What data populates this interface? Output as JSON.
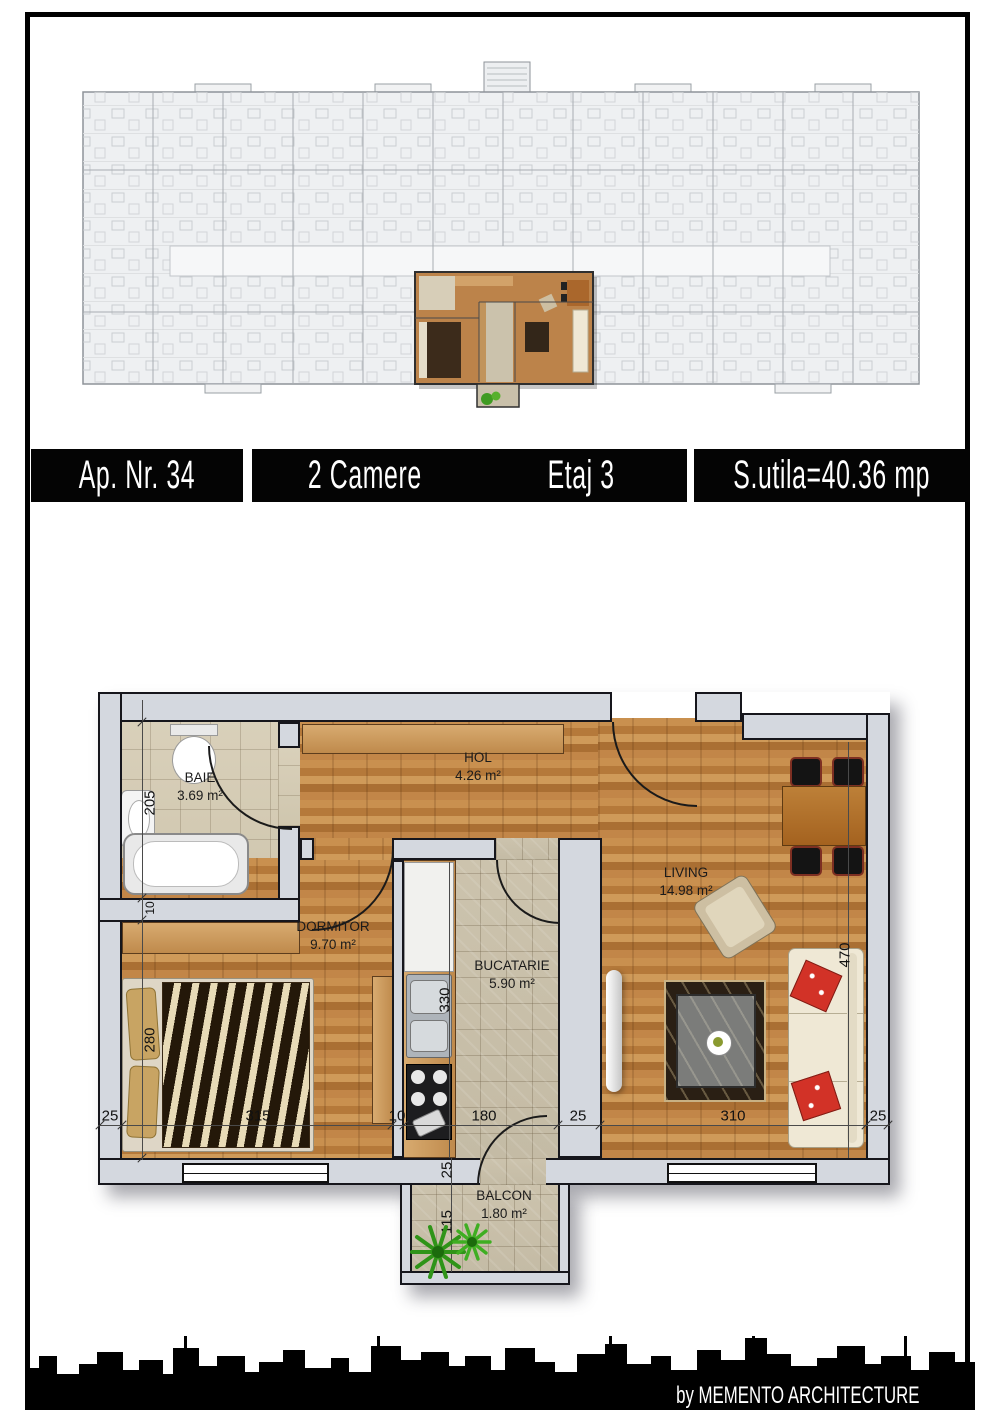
{
  "banner": {
    "items": [
      {
        "label": "Ap. Nr. 34"
      },
      {
        "label": "2 Camere"
      },
      {
        "label": "Etaj 3"
      },
      {
        "label": "S.utila=40.36 mp"
      }
    ]
  },
  "rooms": {
    "baie": {
      "name": "BAIE",
      "area": "3.69 m²"
    },
    "hol": {
      "name": "HOL",
      "area": "4.26 m²"
    },
    "dormitor": {
      "name": "DORMITOR",
      "area": "9.70 m²"
    },
    "bucatarie": {
      "name": "BUCATARIE",
      "area": "5.90 m²"
    },
    "living": {
      "name": "LIVING",
      "area": "14.98 m²"
    },
    "balcon": {
      "name": "BALCON",
      "area": "1.80 m²"
    }
  },
  "dims": {
    "baie_h": "205",
    "wall_top": "10",
    "dorm_h": "280",
    "kitchen_h": "330",
    "living_h": "470",
    "b1": "25",
    "b2": "315",
    "b3": "10",
    "b4": "180",
    "b5": "25",
    "b6": "310",
    "b7": "25",
    "balc_wall": "25",
    "balc_h": "115"
  },
  "credit": "by MEMENTO ARCHITECTURE",
  "colors": {
    "banner_bg": "#040404",
    "banner_text": "#ffffff",
    "wood_floor": "#b97f3e",
    "tile_floor": "#cfc6ae",
    "wall": "#d4d8df",
    "highlight_plant": "#2f9418"
  }
}
